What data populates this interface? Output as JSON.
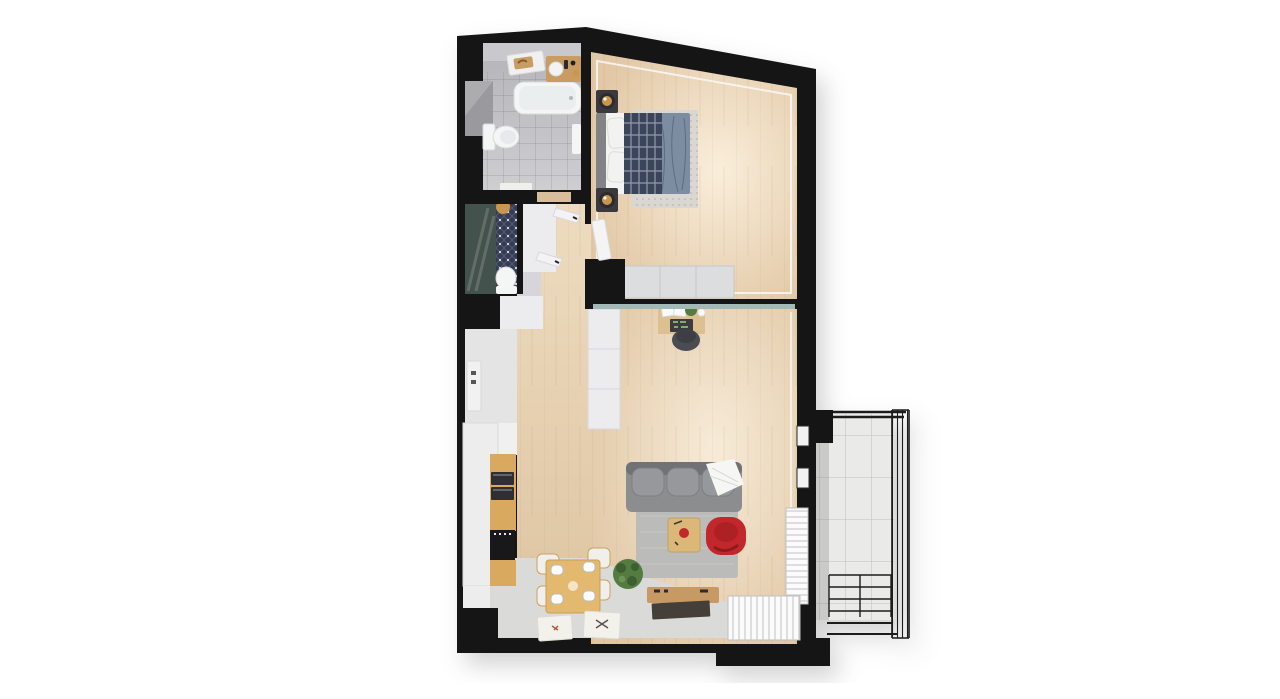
{
  "scene": {
    "label": "3D top-down render of a one-bedroom apartment floor plan with balcony",
    "type": "architectural-floorplan-3d-render",
    "background": "#ffffff",
    "visible_text": []
  },
  "colors": {
    "bg": "#ffffff",
    "wall": "#151515",
    "wood": "#e7d2b6",
    "woodDark": "#d8bd9c",
    "grayFloor": "#dadad8",
    "bathFloor": "#c3c3c7",
    "bathWall": "#9a9a9e",
    "fixture": "#f4f5f5",
    "fixtureShade": "#dfe2e2",
    "vanityWood": "#c89c63",
    "gold": "#c9964f",
    "wcGlass": "#44524e",
    "wcTile": "#343b55",
    "wardrobe": "#ececee",
    "wardrobeShade": "#d6d6da",
    "duvet": "#7d8da1",
    "plaid": "#3a455b",
    "pillow": "#f2f2f1",
    "headboard": "#828387",
    "nightstand": "#3a3a3e",
    "rugBed": "#dad7d3",
    "rugLiving": "#bbbbb9",
    "sofa": "#8c8d8f",
    "sofaDark": "#717275",
    "cushion": "#97989b",
    "blanket": "#f6f6f4",
    "glassTeal": "#a2b9b5",
    "deskWood": "#dcc091",
    "chairDark": "#4b4c51",
    "tableWood": "#e2b96e",
    "chairWhite": "#f0efec",
    "chairTrim": "#c9a35f",
    "red": "#c1272b",
    "redDark": "#a01e22",
    "tvWood": "#c69a62",
    "tvDark": "#453f3a",
    "plant": "#547b40",
    "plantDark": "#3d6030",
    "counter": "#ededee",
    "kitchWood": "#d9a95f",
    "appliance": "#2e2e33",
    "stove": "#18181b",
    "balconyFloor": "#eaeae8",
    "balconyLine": "#d3d3d1",
    "railing": "#1c1c1c",
    "windowWhite": "#fbfbfb",
    "windowLine": "#c7c7c7",
    "trim": "#f8f8f6"
  },
  "rooms": [
    {
      "id": "bathroom",
      "position": "top-left",
      "furniture": [
        "bathtub",
        "vanity-sink",
        "wall-shelf-tray",
        "toilet",
        "towel-rack",
        "bath-mat"
      ]
    },
    {
      "id": "wc-shower-room",
      "position": "left-middle",
      "furniture": [
        "shower-glass",
        "patterned-tile-floor",
        "toilet",
        "round-gold-mirror"
      ]
    },
    {
      "id": "hallway",
      "position": "left-center",
      "furniture": [
        "wardrobe-open-doors",
        "storage-steps",
        "entry-door",
        "light-switches"
      ]
    },
    {
      "id": "bedroom",
      "position": "top-right",
      "furniture": [
        "double-bed",
        "plaid-throw",
        "blue-duvet",
        "pillows",
        "headboard",
        "nightstand-lamp-top",
        "nightstand-lamp-bottom",
        "dotted-rug",
        "wardrobe",
        "bedroom-door"
      ]
    },
    {
      "id": "living-room",
      "position": "center-right",
      "furniture": [
        "glass-partition-strip",
        "desk",
        "desk-chair",
        "tall-wardrobe",
        "sofa",
        "throw-blanket",
        "gray-rug",
        "coffee-table",
        "red-armchair",
        "floor-plant",
        "tv-console",
        "window-right",
        "window-bottom",
        "wall-windows"
      ]
    },
    {
      "id": "kitchen-dining",
      "position": "bottom-left",
      "furniture": [
        "counter-run",
        "tall-oven-column",
        "oven",
        "microwave",
        "black-stove-cabinet",
        "dining-table",
        "dining-chairs-x4",
        "placemat-left",
        "placemat-right"
      ]
    },
    {
      "id": "balcony",
      "position": "right",
      "furniture": [
        "tiled-floor",
        "metal-railing-right",
        "metal-railing-bottom",
        "top-rail"
      ]
    }
  ]
}
